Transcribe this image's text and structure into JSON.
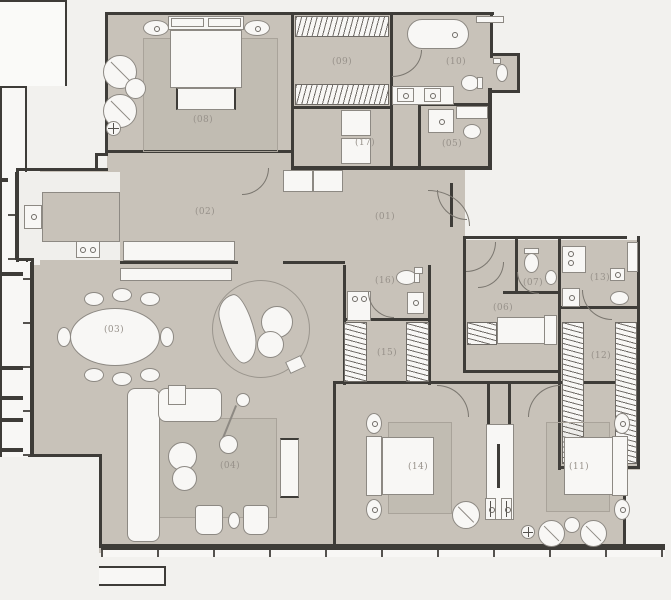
{
  "plan": {
    "type": "apartment-floor-plan",
    "units": "unlabeled",
    "rooms": [
      {
        "id": "01",
        "label": "(01)",
        "name": "entry-hall"
      },
      {
        "id": "02",
        "label": "(02)",
        "name": "gallery-corridor"
      },
      {
        "id": "03",
        "label": "(03)",
        "name": "dining-area"
      },
      {
        "id": "04",
        "label": "(04)",
        "name": "living-room"
      },
      {
        "id": "05",
        "label": "(05)",
        "name": "bathroom"
      },
      {
        "id": "06",
        "label": "(06)",
        "name": "staff-bedroom"
      },
      {
        "id": "07",
        "label": "(07)",
        "name": "staff-bathroom"
      },
      {
        "id": "08",
        "label": "(08)",
        "name": "master-bedroom"
      },
      {
        "id": "09",
        "label": "(09)",
        "name": "walk-in-closet"
      },
      {
        "id": "10",
        "label": "(10)",
        "name": "master-bathroom"
      },
      {
        "id": "11",
        "label": "(11)",
        "name": "bedroom-2"
      },
      {
        "id": "12",
        "label": "(12)",
        "name": "closet-2"
      },
      {
        "id": "13",
        "label": "(13)",
        "name": "laundry-wc"
      },
      {
        "id": "14",
        "label": "(14)",
        "name": "bedroom-1"
      },
      {
        "id": "15",
        "label": "(15)",
        "name": "closet-1"
      },
      {
        "id": "16",
        "label": "(16)",
        "name": "powder-room"
      },
      {
        "id": "17",
        "label": "(17)",
        "name": "storage"
      }
    ],
    "colors": {
      "paper": "#f2f1ee",
      "floor_fill": "#c8c2b9",
      "walls": "#3e3c38",
      "fixtures": "#f8f7f5",
      "outlines": "#8d8983",
      "labels": "#97918a"
    },
    "icons": {
      "bed-icon": "rect+pillows",
      "bathtub-icon": "rounded-rect",
      "toilet-icon": "oval+tank",
      "sink-icon": "square+circle",
      "shower-icon": "square+dot",
      "hanger-rail-icon": "striped-strip",
      "sofa-icon": "L-rects",
      "armchair-icon": "circle+diagonal",
      "dining-table-icon": "ellipse+chairs",
      "cooktop-icon": "rect+2-burners",
      "washer-icon": "square+dot",
      "door-swing-icon": "quarter-arc",
      "column-icon": "white-rect",
      "stool-icon": "phi-rect",
      "floor-lamp-icon": "circle+cross"
    }
  }
}
